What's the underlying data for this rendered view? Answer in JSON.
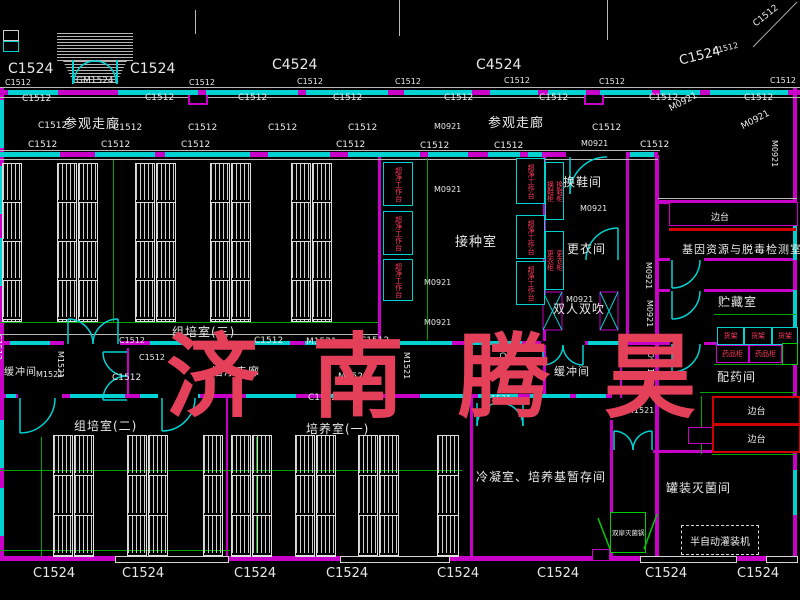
{
  "watermark": "济南腾昊",
  "colors": {
    "wall": "#c800c8",
    "window": "#00d2d2",
    "dimension": "#00a600",
    "text": "#e8e8e8",
    "equipment_text": "#ff3a5e",
    "bench_border": "#d40000",
    "watermark": "#e5405a",
    "sterilizer": "#00cc00",
    "sink": "#ffd400"
  },
  "rooms": [
    {
      "label": "参观走廊",
      "x": 64,
      "y": 118,
      "s": 13
    },
    {
      "label": "参观走廊",
      "x": 488,
      "y": 117,
      "s": 13
    },
    {
      "label": "组培室(三)",
      "x": 172,
      "y": 326,
      "s": 12
    },
    {
      "label": "缓冲间",
      "x": 4,
      "y": 368,
      "s": 10
    },
    {
      "label": "洁净走廊",
      "x": 212,
      "y": 366,
      "s": 11
    },
    {
      "label": "组培室(二)",
      "x": 74,
      "y": 420,
      "s": 12
    },
    {
      "label": "培养室(一)",
      "x": 306,
      "y": 423,
      "s": 12
    },
    {
      "label": "接种室",
      "x": 455,
      "y": 236,
      "s": 13
    },
    {
      "label": "换鞋间",
      "x": 563,
      "y": 176,
      "s": 12
    },
    {
      "label": "更衣间",
      "x": 567,
      "y": 243,
      "s": 12
    },
    {
      "label": "双人双吹",
      "x": 553,
      "y": 303,
      "s": 12
    },
    {
      "label": "缓冲间",
      "x": 554,
      "y": 366,
      "s": 11
    },
    {
      "label": "基因资源与脱毒检测室",
      "x": 682,
      "y": 244,
      "s": 11
    },
    {
      "label": "贮藏室",
      "x": 718,
      "y": 296,
      "s": 12
    },
    {
      "label": "配药间",
      "x": 717,
      "y": 371,
      "s": 12
    },
    {
      "label": "罐装灭菌间",
      "x": 666,
      "y": 482,
      "s": 12
    },
    {
      "label": "冷凝室、培养基暂存间",
      "x": 476,
      "y": 471,
      "s": 12
    }
  ],
  "equipment": {
    "bench": "超净工作台",
    "shoe_cabinet": "换鞋柜",
    "locker": "更衣柜",
    "shelf": "货架",
    "medicine_cabinet": "药品柜",
    "side_bench": "边台",
    "sterilizer": "双扉灭菌锅",
    "filling_machine": "半自动灌装机"
  },
  "codes": [
    {
      "t": "C1524",
      "x": 8,
      "y": 62,
      "s": 14
    },
    {
      "t": "C1524",
      "x": 130,
      "y": 62,
      "s": 14
    },
    {
      "t": "C4524",
      "x": 272,
      "y": 58,
      "s": 14
    },
    {
      "t": "C4524",
      "x": 476,
      "y": 58,
      "s": 14
    },
    {
      "t": "C1524",
      "x": 678,
      "y": 55,
      "s": 13,
      "r": -14
    },
    {
      "t": "C1512",
      "x": 712,
      "y": 48,
      "s": 8,
      "r": -14
    },
    {
      "t": "C1512",
      "x": 752,
      "y": 22,
      "s": 9,
      "r": -38
    },
    {
      "t": "C1512",
      "x": 5,
      "y": 79,
      "s": 8
    },
    {
      "t": "GM1524",
      "x": 76,
      "y": 77,
      "s": 9
    },
    {
      "t": "C1512",
      "x": 189,
      "y": 79,
      "s": 8
    },
    {
      "t": "C1512",
      "x": 297,
      "y": 78,
      "s": 8
    },
    {
      "t": "C1512",
      "x": 395,
      "y": 78,
      "s": 8
    },
    {
      "t": "C1512",
      "x": 504,
      "y": 77,
      "s": 8
    },
    {
      "t": "C1512",
      "x": 599,
      "y": 78,
      "s": 8
    },
    {
      "t": "C1512",
      "x": 770,
      "y": 77,
      "s": 8
    },
    {
      "t": "C1512",
      "x": 22,
      "y": 95,
      "s": 9
    },
    {
      "t": "C1512",
      "x": 145,
      "y": 94,
      "s": 9
    },
    {
      "t": "C1512",
      "x": 238,
      "y": 94,
      "s": 9
    },
    {
      "t": "C1512",
      "x": 333,
      "y": 94,
      "s": 9
    },
    {
      "t": "C1512",
      "x": 444,
      "y": 94,
      "s": 9
    },
    {
      "t": "C1512",
      "x": 539,
      "y": 94,
      "s": 9
    },
    {
      "t": "C1512",
      "x": 649,
      "y": 94,
      "s": 9
    },
    {
      "t": "C1512",
      "x": 744,
      "y": 94,
      "s": 9
    },
    {
      "t": "C1512",
      "x": 38,
      "y": 122,
      "s": 9
    },
    {
      "t": "C1512",
      "x": 113,
      "y": 124,
      "s": 9
    },
    {
      "t": "C1512",
      "x": 188,
      "y": 124,
      "s": 9
    },
    {
      "t": "C1512",
      "x": 268,
      "y": 124,
      "s": 9
    },
    {
      "t": "C1512",
      "x": 348,
      "y": 124,
      "s": 9
    },
    {
      "t": "M0921",
      "x": 434,
      "y": 123,
      "s": 8
    },
    {
      "t": "C1512",
      "x": 592,
      "y": 124,
      "s": 9
    },
    {
      "t": "C1512",
      "x": 28,
      "y": 141,
      "s": 9
    },
    {
      "t": "C1512",
      "x": 101,
      "y": 141,
      "s": 9
    },
    {
      "t": "C1512",
      "x": 181,
      "y": 141,
      "s": 9
    },
    {
      "t": "C1512",
      "x": 336,
      "y": 141,
      "s": 9
    },
    {
      "t": "C1512",
      "x": 420,
      "y": 142,
      "s": 9
    },
    {
      "t": "C1512",
      "x": 494,
      "y": 142,
      "s": 9
    },
    {
      "t": "M0921",
      "x": 581,
      "y": 140,
      "s": 8
    },
    {
      "t": "C1512",
      "x": 640,
      "y": 141,
      "s": 9
    },
    {
      "t": "M0921",
      "x": 668,
      "y": 106,
      "s": 9,
      "r": -28
    },
    {
      "t": "M0921",
      "x": 740,
      "y": 124,
      "s": 9,
      "r": -28
    },
    {
      "t": "M0921",
      "x": 778,
      "y": 140,
      "s": 8,
      "r": 90
    },
    {
      "t": "M0921",
      "x": 434,
      "y": 186,
      "s": 8
    },
    {
      "t": "M0921",
      "x": 424,
      "y": 279,
      "s": 8
    },
    {
      "t": "M0921",
      "x": 424,
      "y": 319,
      "s": 8
    },
    {
      "t": "M0921",
      "x": 580,
      "y": 205,
      "s": 8
    },
    {
      "t": "M0921",
      "x": 566,
      "y": 296,
      "s": 8
    },
    {
      "t": "M0921",
      "x": 652,
      "y": 262,
      "s": 8,
      "r": 90
    },
    {
      "t": "M0921",
      "x": 653,
      "y": 300,
      "s": 8,
      "r": 90
    },
    {
      "t": "M0921",
      "x": 654,
      "y": 346,
      "s": 8,
      "r": 90
    },
    {
      "t": "M1521",
      "x": 36,
      "y": 371,
      "s": 8
    },
    {
      "t": "M1521",
      "x": 64,
      "y": 351,
      "s": 8,
      "r": 90
    },
    {
      "t": "C1512",
      "x": 119,
      "y": 337,
      "s": 8
    },
    {
      "t": "C1512",
      "x": 139,
      "y": 354,
      "s": 8
    },
    {
      "t": "C1512",
      "x": 112,
      "y": 374,
      "s": 9
    },
    {
      "t": "C1512",
      "x": 2,
      "y": 334,
      "s": 8,
      "r": 90
    },
    {
      "t": "C1512",
      "x": 254,
      "y": 337,
      "s": 9
    },
    {
      "t": "M1521",
      "x": 306,
      "y": 338,
      "s": 9
    },
    {
      "t": "C1512",
      "x": 360,
      "y": 337,
      "s": 9
    },
    {
      "t": "M1521",
      "x": 338,
      "y": 373,
      "s": 9
    },
    {
      "t": "C1512",
      "x": 308,
      "y": 394,
      "s": 9
    },
    {
      "t": "M1521",
      "x": 410,
      "y": 352,
      "s": 8,
      "r": 90
    },
    {
      "t": "C1512",
      "x": 506,
      "y": 352,
      "s": 8,
      "r": 90
    },
    {
      "t": "M1521",
      "x": 484,
      "y": 395,
      "s": 8
    },
    {
      "t": "M1521",
      "x": 627,
      "y": 407,
      "s": 8
    },
    {
      "t": "C1524",
      "x": 33,
      "y": 567,
      "s": 13
    },
    {
      "t": "C1524",
      "x": 122,
      "y": 567,
      "s": 13
    },
    {
      "t": "C1524",
      "x": 234,
      "y": 567,
      "s": 13
    },
    {
      "t": "C1524",
      "x": 326,
      "y": 567,
      "s": 13
    },
    {
      "t": "C1524",
      "x": 437,
      "y": 567,
      "s": 13
    },
    {
      "t": "C1524",
      "x": 537,
      "y": 567,
      "s": 13
    },
    {
      "t": "C1524",
      "x": 645,
      "y": 567,
      "s": 13
    },
    {
      "t": "C1524",
      "x": 737,
      "y": 567,
      "s": 13
    }
  ]
}
